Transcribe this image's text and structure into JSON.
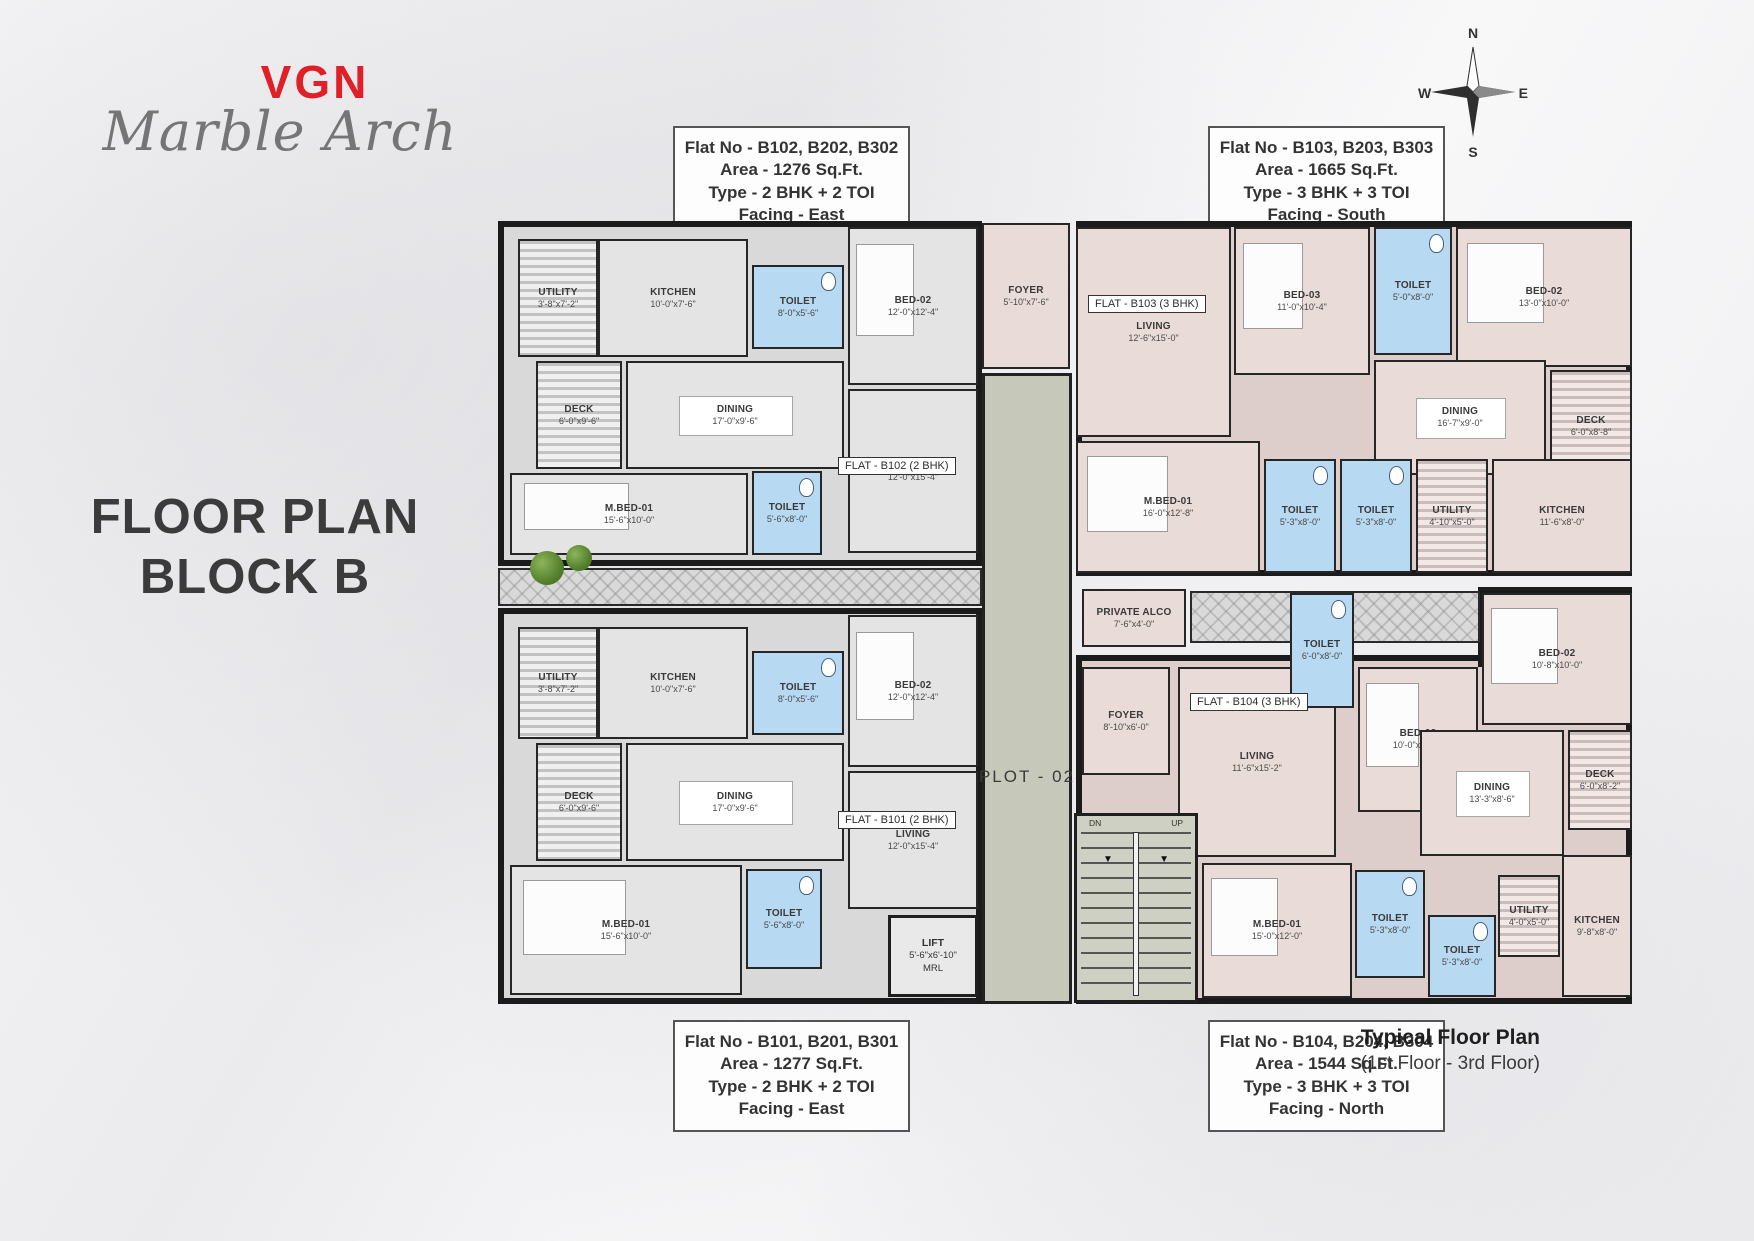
{
  "brand": {
    "logo": "VGN",
    "name": "Marble Arch"
  },
  "title": {
    "line1": "FLOOR PLAN",
    "line2": "BLOCK B"
  },
  "info_boxes": [
    {
      "lines": [
        "Flat No - B102, B202, B302",
        "Area - 1276 Sq.Ft.",
        "Type - 2 BHK + 2 TOI",
        "Facing - East"
      ]
    },
    {
      "lines": [
        "Flat No - B103, B203, B303",
        "Area - 1665 Sq.Ft.",
        "Type - 3 BHK + 3 TOI",
        "Facing - South"
      ]
    },
    {
      "lines": [
        "Flat No - B101, B201, B301",
        "Area - 1277 Sq.Ft.",
        "Type - 2 BHK + 2 TOI",
        "Facing - East"
      ]
    },
    {
      "lines": [
        "Flat No - B104, B204, B304",
        "Area - 1544 Sq.Ft.",
        "Type - 3 BHK + 3 TOI",
        "Facing - North"
      ]
    }
  ],
  "compass": {
    "n": "N",
    "w": "W",
    "e": "E",
    "s": "S"
  },
  "footer": {
    "title": "Typical Floor Plan",
    "subtitle": "(1st Floor - 3rd Floor)"
  },
  "colors": {
    "brand_red": "#e01f26",
    "toilet_blue": "#b7d9f1",
    "flat_gray": "#e4e4e4",
    "flat_pink": "#e9dbd8",
    "corridor_green": "#c6c9ba",
    "wall": "#1b1b1b"
  },
  "plan": {
    "plot_label": "PLOT - 02",
    "lift": {
      "name": "LIFT",
      "dims": "5'-6\"x6'-10\"",
      "note": "MRL"
    },
    "stairs": {
      "down": "DN",
      "up": "UP"
    },
    "flat_tags": [
      {
        "flat": "B102",
        "label": "FLAT - B102 (2 BHK)",
        "x": 348,
        "y": 242
      },
      {
        "flat": "B101",
        "label": "FLAT - B101 (2 BHK)",
        "x": 348,
        "y": 596
      },
      {
        "flat": "B103",
        "label": "FLAT - B103 (3 BHK)",
        "x": 598,
        "y": 80
      },
      {
        "flat": "B104",
        "label": "FLAT - B104 (3 BHK)",
        "x": 700,
        "y": 478
      }
    ],
    "rooms": [
      {
        "flat": "B102",
        "name": "UTILITY",
        "dims": "3'-8\"x7'-2\"",
        "kind": "utility",
        "tone": "gray",
        "x": 28,
        "y": 24,
        "w": 80,
        "h": 118
      },
      {
        "flat": "B102",
        "name": "KITCHEN",
        "dims": "10'-0\"x7'-6\"",
        "kind": "plain",
        "tone": "gray",
        "x": 108,
        "y": 24,
        "w": 150,
        "h": 118
      },
      {
        "flat": "B102",
        "name": "TOILET",
        "dims": "8'-0\"x5'-6\"",
        "kind": "toilet",
        "tone": "gray",
        "x": 262,
        "y": 50,
        "w": 92,
        "h": 84
      },
      {
        "flat": "B102",
        "name": "BED-02",
        "dims": "12'-0\"x12'-4\"",
        "kind": "bed",
        "tone": "gray",
        "x": 358,
        "y": 12,
        "w": 130,
        "h": 158
      },
      {
        "flat": "B102",
        "name": "DECK",
        "dims": "6'-0\"x9'-6\"",
        "kind": "deck",
        "tone": "gray",
        "x": 46,
        "y": 146,
        "w": 86,
        "h": 108
      },
      {
        "flat": "B102",
        "name": "DINING",
        "dims": "17'-0\"x9'-6\"",
        "kind": "dining",
        "tone": "gray",
        "x": 136,
        "y": 146,
        "w": 218,
        "h": 108
      },
      {
        "flat": "B102",
        "name": "M.BED-01",
        "dims": "15'-6\"x10'-0\"",
        "kind": "bed",
        "tone": "gray",
        "x": 20,
        "y": 258,
        "w": 238,
        "h": 82
      },
      {
        "flat": "B102",
        "name": "TOILET",
        "dims": "5'-6\"x8'-0\"",
        "kind": "toilet",
        "tone": "gray",
        "x": 262,
        "y": 256,
        "w": 70,
        "h": 84
      },
      {
        "flat": "B102",
        "name": "LIVING",
        "dims": "12'-0\"x15'-4\"",
        "kind": "plain",
        "tone": "gray",
        "x": 358,
        "y": 174,
        "w": 130,
        "h": 164
      },
      {
        "flat": "B101",
        "name": "UTILITY",
        "dims": "3'-8\"x7'-2\"",
        "kind": "utility",
        "tone": "gray",
        "x": 28,
        "y": 412,
        "w": 80,
        "h": 112
      },
      {
        "flat": "B101",
        "name": "KITCHEN",
        "dims": "10'-0\"x7'-6\"",
        "kind": "plain",
        "tone": "gray",
        "x": 108,
        "y": 412,
        "w": 150,
        "h": 112
      },
      {
        "flat": "B101",
        "name": "TOILET",
        "dims": "8'-0\"x5'-6\"",
        "kind": "toilet",
        "tone": "gray",
        "x": 262,
        "y": 436,
        "w": 92,
        "h": 84
      },
      {
        "flat": "B101",
        "name": "BED-02",
        "dims": "12'-0\"x12'-4\"",
        "kind": "bed",
        "tone": "gray",
        "x": 358,
        "y": 400,
        "w": 130,
        "h": 152
      },
      {
        "flat": "B101",
        "name": "DECK",
        "dims": "6'-0\"x9'-6\"",
        "kind": "deck",
        "tone": "gray",
        "x": 46,
        "y": 528,
        "w": 86,
        "h": 118
      },
      {
        "flat": "B101",
        "name": "DINING",
        "dims": "17'-0\"x9'-6\"",
        "kind": "dining",
        "tone": "gray",
        "x": 136,
        "y": 528,
        "w": 218,
        "h": 118
      },
      {
        "flat": "B101",
        "name": "M.BED-01",
        "dims": "15'-6\"x10'-0\"",
        "kind": "bed",
        "tone": "gray",
        "x": 20,
        "y": 650,
        "w": 232,
        "h": 130
      },
      {
        "flat": "B101",
        "name": "TOILET",
        "dims": "5'-6\"x8'-0\"",
        "kind": "toilet",
        "tone": "gray",
        "x": 256,
        "y": 654,
        "w": 76,
        "h": 100
      },
      {
        "flat": "B101",
        "name": "LIVING",
        "dims": "12'-0\"x15'-4\"",
        "kind": "plain",
        "tone": "gray",
        "x": 358,
        "y": 556,
        "w": 130,
        "h": 138
      },
      {
        "flat": "B103",
        "name": "FOYER",
        "dims": "5'-10\"x7'-6\"",
        "kind": "plain",
        "tone": "pink",
        "x": 492,
        "y": 8,
        "w": 88,
        "h": 146
      },
      {
        "flat": "B103",
        "name": "LIVING",
        "dims": "12'-6\"x15'-0\"",
        "kind": "plain",
        "tone": "pink",
        "x": 586,
        "y": 12,
        "w": 155,
        "h": 210
      },
      {
        "flat": "B103",
        "name": "BED-03",
        "dims": "11'-0\"x10'-4\"",
        "kind": "bed",
        "tone": "pink",
        "x": 744,
        "y": 12,
        "w": 136,
        "h": 148
      },
      {
        "flat": "B103",
        "name": "TOILET",
        "dims": "5'-0\"x8'-0\"",
        "kind": "toilet",
        "tone": "pink",
        "x": 884,
        "y": 12,
        "w": 78,
        "h": 128
      },
      {
        "flat": "B103",
        "name": "BED-02",
        "dims": "13'-0\"x10'-0\"",
        "kind": "bed",
        "tone": "pink",
        "x": 966,
        "y": 12,
        "w": 176,
        "h": 140
      },
      {
        "flat": "B103",
        "name": "DINING",
        "dims": "16'-7\"x9'-0\"",
        "kind": "dining",
        "tone": "pink",
        "x": 884,
        "y": 145,
        "w": 172,
        "h": 115
      },
      {
        "flat": "B103",
        "name": "DECK",
        "dims": "6'-0\"x8'-8\"",
        "kind": "deck",
        "tone": "pink",
        "x": 1060,
        "y": 155,
        "w": 82,
        "h": 112
      },
      {
        "flat": "B103",
        "name": "M.BED-01",
        "dims": "16'-0\"x12'-8\"",
        "kind": "bed",
        "tone": "pink",
        "x": 586,
        "y": 226,
        "w": 184,
        "h": 132
      },
      {
        "flat": "B103",
        "name": "TOILET",
        "dims": "5'-3\"x8'-0\"",
        "kind": "toilet",
        "tone": "pink",
        "x": 774,
        "y": 244,
        "w": 72,
        "h": 114
      },
      {
        "flat": "B103",
        "name": "TOILET",
        "dims": "5'-3\"x8'-0\"",
        "kind": "toilet",
        "tone": "pink",
        "x": 850,
        "y": 244,
        "w": 72,
        "h": 114
      },
      {
        "flat": "B103",
        "name": "UTILITY",
        "dims": "4'-10\"x5'-0\"",
        "kind": "utility",
        "tone": "pink",
        "x": 926,
        "y": 244,
        "w": 72,
        "h": 114
      },
      {
        "flat": "B103",
        "name": "KITCHEN",
        "dims": "11'-6\"x8'-0\"",
        "kind": "plain",
        "tone": "pink",
        "x": 1002,
        "y": 244,
        "w": 140,
        "h": 114
      },
      {
        "flat": "B103",
        "name": "PRIVATE ALCO",
        "dims": "7'-6\"x4'-0\"",
        "kind": "plain",
        "tone": "pink",
        "x": 592,
        "y": 374,
        "w": 104,
        "h": 58
      },
      {
        "flat": "B104",
        "name": "FOYER",
        "dims": "8'-10\"x6'-0\"",
        "kind": "plain",
        "tone": "pink",
        "x": 592,
        "y": 452,
        "w": 88,
        "h": 108
      },
      {
        "flat": "B104",
        "name": "LIVING",
        "dims": "11'-6\"x15'-2\"",
        "kind": "plain",
        "tone": "pink",
        "x": 688,
        "y": 452,
        "w": 158,
        "h": 190
      },
      {
        "flat": "B104",
        "name": "TOILET",
        "dims": "6'-0\"x8'-0\"",
        "kind": "toilet",
        "tone": "pink",
        "x": 800,
        "y": 378,
        "w": 64,
        "h": 115
      },
      {
        "flat": "B104",
        "name": "BED-03",
        "dims": "10'-0\"x10'-4\"",
        "kind": "bed",
        "tone": "pink",
        "x": 868,
        "y": 452,
        "w": 120,
        "h": 145
      },
      {
        "flat": "B104",
        "name": "BED-02",
        "dims": "10'-8\"x10'-0\"",
        "kind": "bed",
        "tone": "pink",
        "x": 992,
        "y": 378,
        "w": 150,
        "h": 132
      },
      {
        "flat": "B104",
        "name": "DINING",
        "dims": "13'-3\"x8'-6\"",
        "kind": "dining",
        "tone": "pink",
        "x": 930,
        "y": 515,
        "w": 144,
        "h": 126
      },
      {
        "flat": "B104",
        "name": "DECK",
        "dims": "6'-0\"x8'-2\"",
        "kind": "deck",
        "tone": "pink",
        "x": 1078,
        "y": 515,
        "w": 64,
        "h": 100
      },
      {
        "flat": "B104",
        "name": "M.BED-01",
        "dims": "15'-0\"x12'-0\"",
        "kind": "bed",
        "tone": "pink",
        "x": 712,
        "y": 648,
        "w": 150,
        "h": 135
      },
      {
        "flat": "B104",
        "name": "TOILET",
        "dims": "5'-3\"x8'-0\"",
        "kind": "toilet",
        "tone": "pink",
        "x": 865,
        "y": 655,
        "w": 70,
        "h": 108
      },
      {
        "flat": "B104",
        "name": "TOILET",
        "dims": "5'-3\"x8'-0\"",
        "kind": "toilet",
        "tone": "pink",
        "x": 938,
        "y": 700,
        "w": 68,
        "h": 82
      },
      {
        "flat": "B104",
        "name": "UTILITY",
        "dims": "4'-0\"x5'-0\"",
        "kind": "utility",
        "tone": "pink",
        "x": 1008,
        "y": 660,
        "w": 62,
        "h": 82
      },
      {
        "flat": "B104",
        "name": "KITCHEN",
        "dims": "9'-8\"x8'-0\"",
        "kind": "plain",
        "tone": "pink",
        "x": 1072,
        "y": 640,
        "w": 70,
        "h": 142
      }
    ]
  }
}
